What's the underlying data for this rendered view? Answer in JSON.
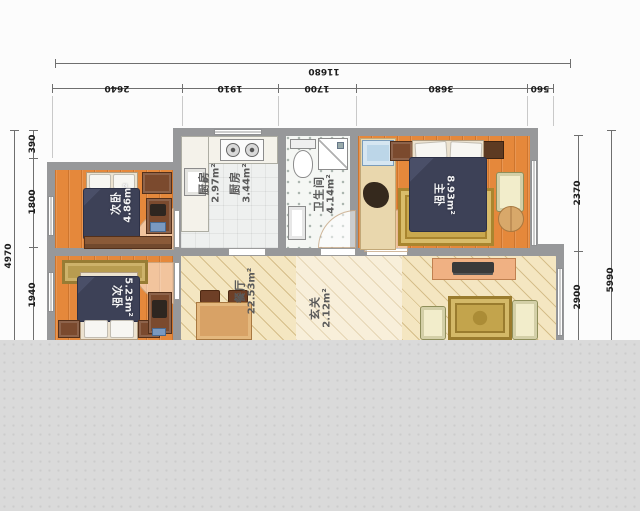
{
  "title": "三室户型图 (3-bedroom apartment floor plan)",
  "dimensions": {
    "top": {
      "overall": "11680",
      "segments": [
        "2640",
        "1910",
        "1700",
        "3680",
        "560"
      ]
    },
    "left": {
      "overall": "4970",
      "segments": [
        "390",
        "1800",
        "1940"
      ]
    },
    "right": {
      "overall": "5990",
      "segments": [
        "2370",
        "2900"
      ]
    }
  },
  "rooms": {
    "kitchen_a": {
      "name": "厨房",
      "area": "2.97m²"
    },
    "kitchen_b": {
      "name": "厨房",
      "area": "3.44m²"
    },
    "bathroom": {
      "name": "卫生间",
      "area": "4.14m²"
    },
    "master_bedroom": {
      "name": "主卧",
      "area": "8.93m²"
    },
    "bedroom_upper": {
      "name": "次卧",
      "area": "4.86m²"
    },
    "bedroom_lower": {
      "name": "次卧",
      "area": "5.23m²"
    },
    "dining": {
      "name": "餐厅",
      "area": "22.53m²"
    },
    "entry": {
      "name": "玄关",
      "area": "2.12m²"
    }
  },
  "colors": {
    "wall": "#97989a",
    "wood_floor": "#e5883b",
    "dining_floor": "#f4e6c1",
    "bed": "#3d4157",
    "rug": "#c9a84e",
    "background_band": "#d9d9d9"
  }
}
